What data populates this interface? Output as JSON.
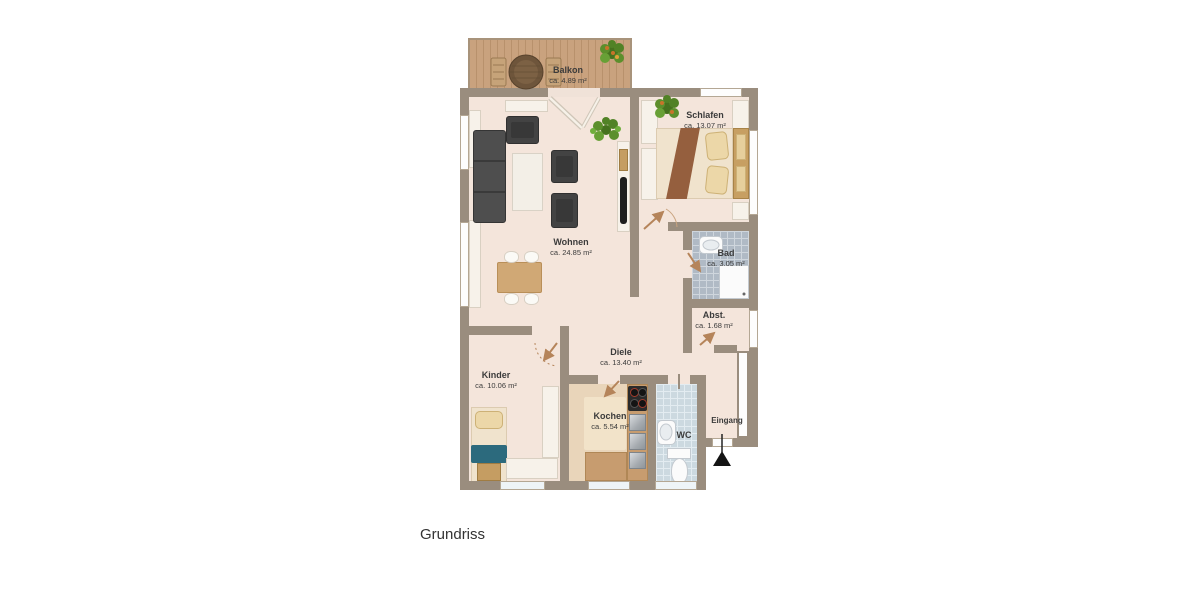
{
  "page": {
    "caption": "Grundriss"
  },
  "colors": {
    "wall": "#9a8d7e",
    "floor": "#f4e5db",
    "balcony_deck": "#c9a27e",
    "bad_tile": "#b0bac5",
    "wc_tile": "#ccd9e0",
    "kitchen_floor": "#e9d5ba",
    "door_arrow": "#b5845a",
    "bed_blanket": "#955f3e",
    "kids_blanket_teal": "#2c6a7d",
    "plant_green": "#5c8f2c"
  },
  "icons": {
    "entrance_arrow": "triangle-up",
    "door_swing": "arrow-with-arc"
  },
  "rooms": {
    "balkon": {
      "name": "Balkon",
      "area": "ca. 4.89 m²"
    },
    "wohnen": {
      "name": "Wohnen",
      "area": "ca. 24.85 m²"
    },
    "schlafen": {
      "name": "Schlafen",
      "area": "ca. 13.07 m²"
    },
    "bad": {
      "name": "Bad",
      "area": "ca. 3.05 m²"
    },
    "abstellraum": {
      "name": "Abst.",
      "area": "ca. 1.68 m²"
    },
    "diele": {
      "name": "Diele",
      "area": "ca. 13.40 m²"
    },
    "kinder": {
      "name": "Kinder",
      "area": "ca. 10.06 m²"
    },
    "kochen": {
      "name": "Kochen",
      "area": "ca. 5.54 m²"
    },
    "wc": {
      "name": "WC"
    },
    "eingang": {
      "name": "Eingang"
    }
  }
}
